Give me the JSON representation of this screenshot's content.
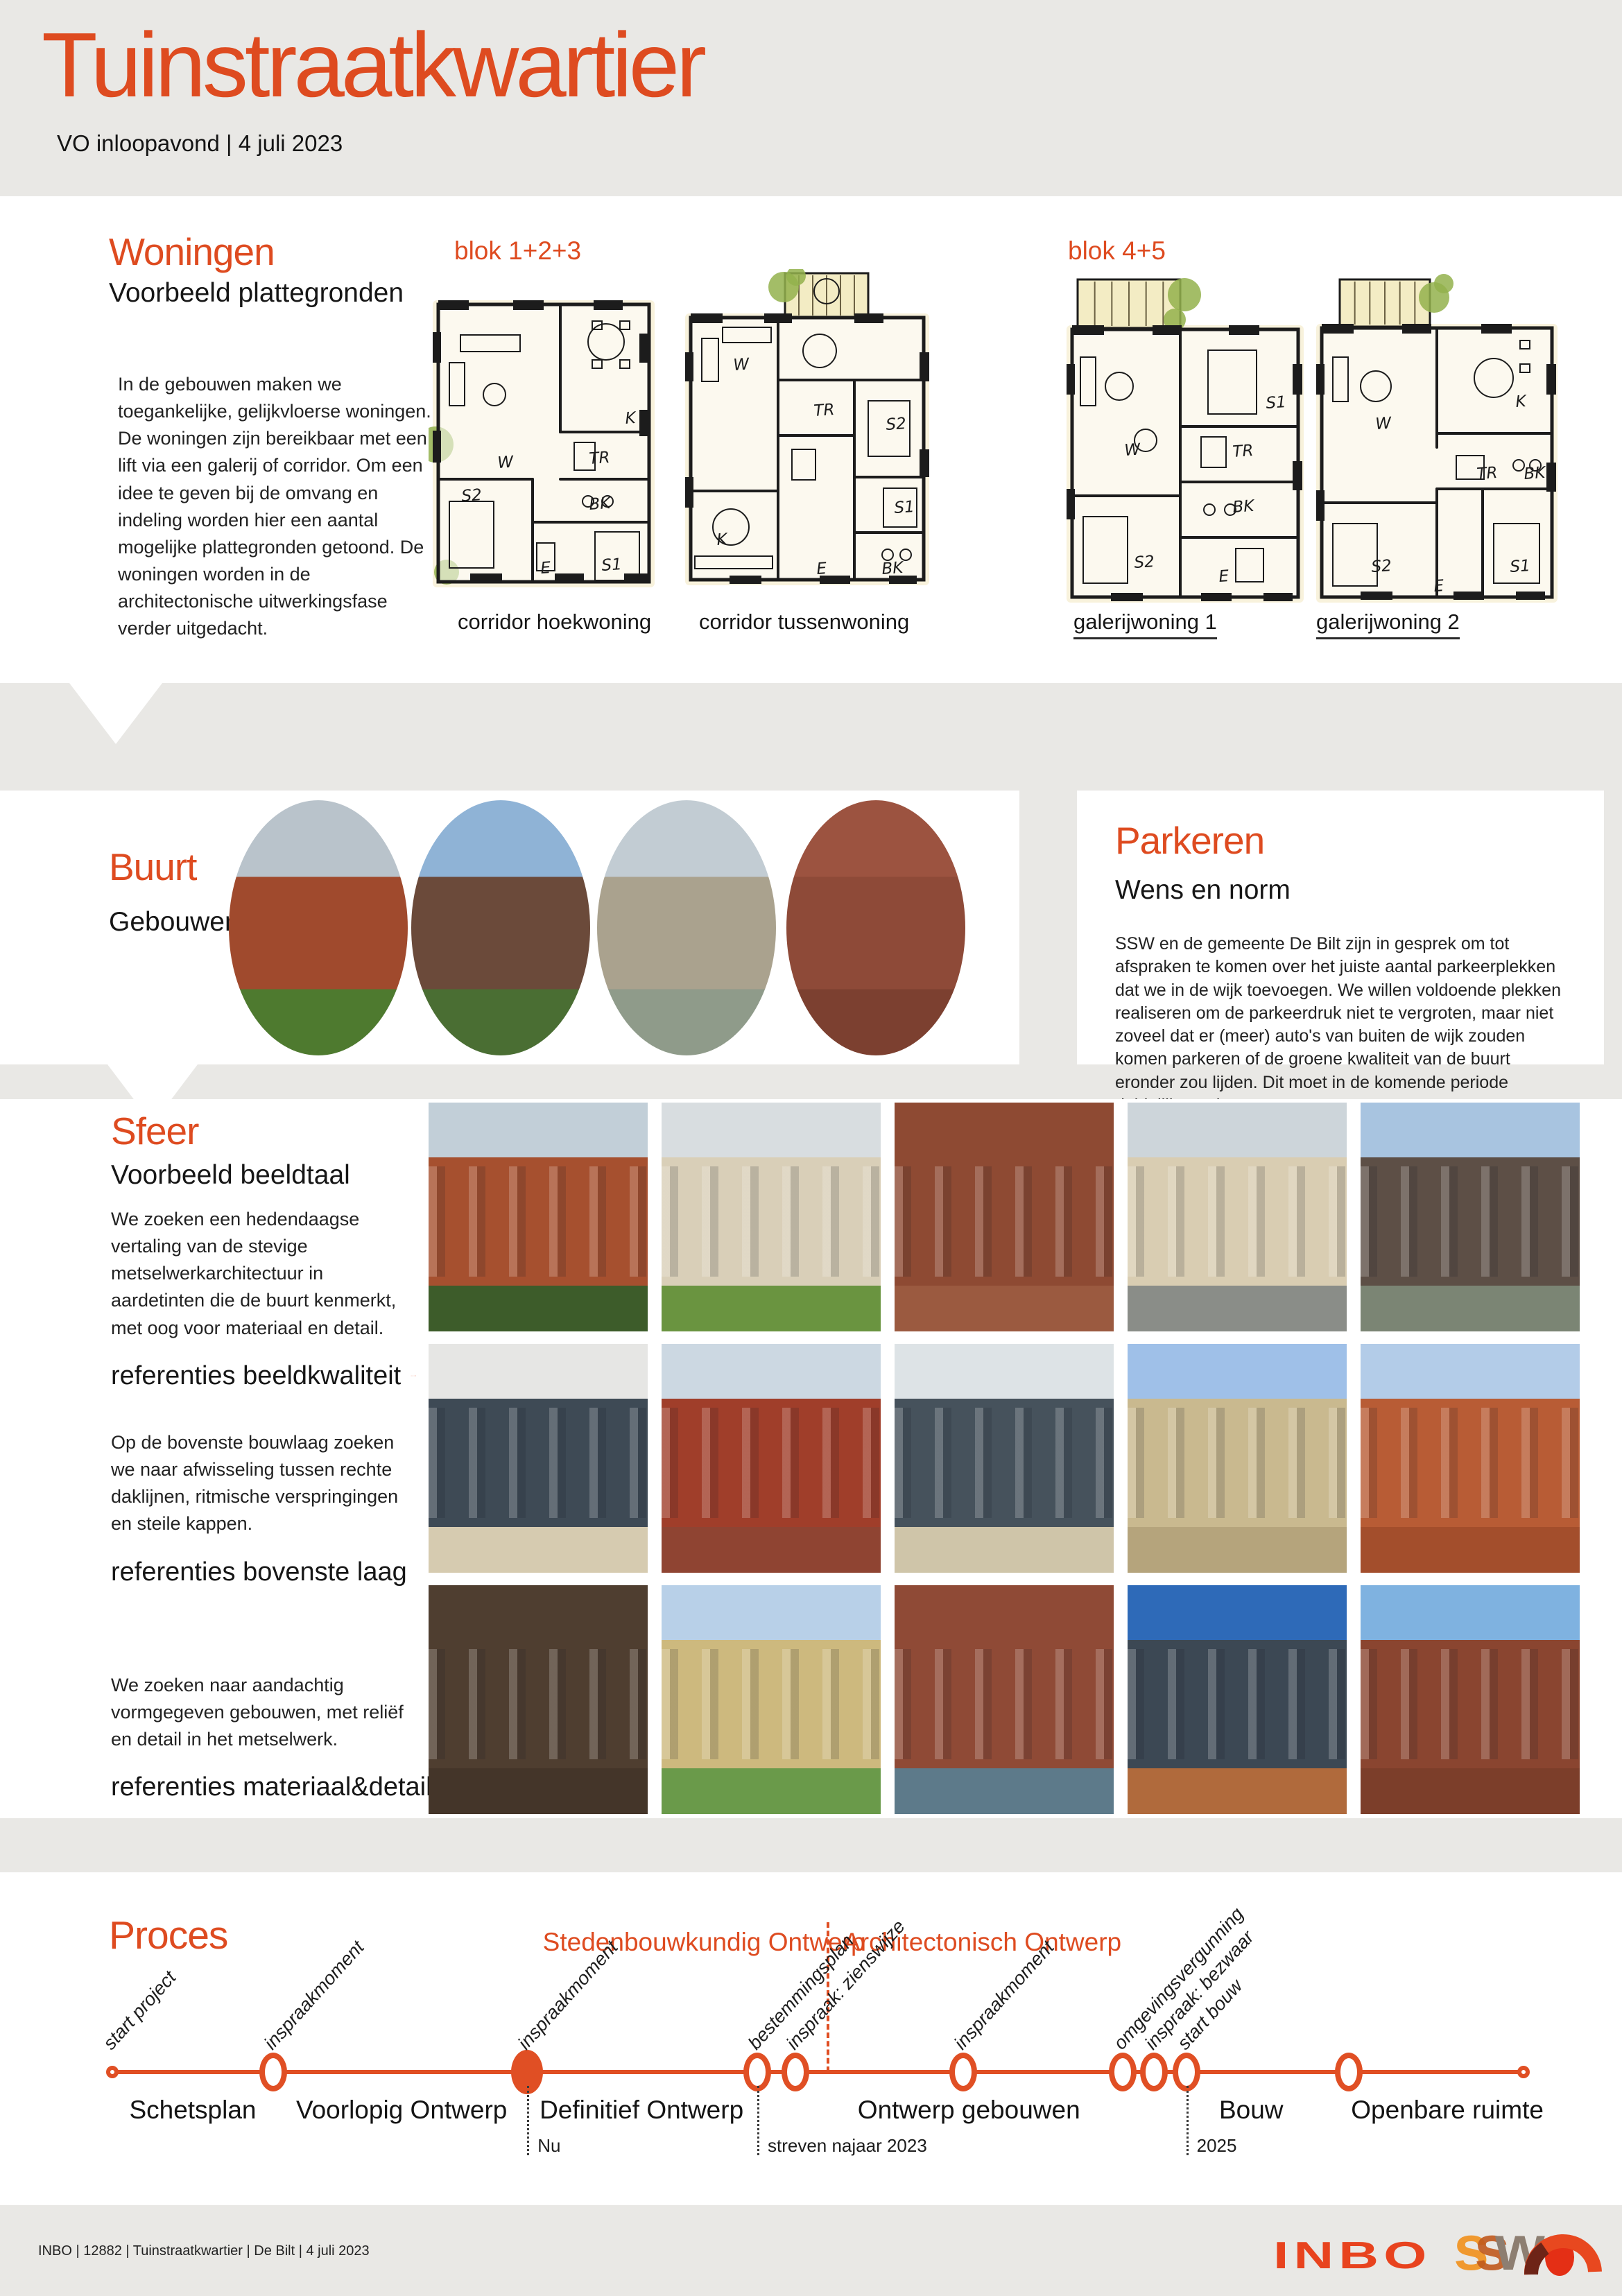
{
  "page": {
    "title": "Tuinstraatkwartier",
    "subtitle": "VO inloopavond | 4 juli 2023",
    "accent": "#de4b20"
  },
  "woningen": {
    "title": "Woningen",
    "subtitle": "Voorbeeld plattegronden",
    "body": "In de gebouwen maken we toegankelijke, gelijkvloerse woningen. De woningen zijn bereikbaar met een lift via een galerij of corridor. Om een idee te geven bij de omvang en indeling worden hier een aantal mogelijke plattegronden getoond. De woningen worden in de architectonische uitwerkingsfase verder uitgedacht.",
    "blok_labels": [
      "blok 1+2+3",
      "blok 4+5"
    ],
    "plans": [
      {
        "label": "corridor hoekwoning",
        "rooms": [
          "W",
          "K",
          "TR",
          "BK",
          "S2",
          "S1",
          "E"
        ]
      },
      {
        "label": "corridor tussenwoning",
        "rooms": [
          "W",
          "K",
          "S2",
          "S1",
          "TR",
          "BK",
          "E"
        ]
      },
      {
        "label": "galerijwoning 1",
        "rooms": [
          "W",
          "S1",
          "TR",
          "BK",
          "S2",
          "E"
        ]
      },
      {
        "label": "galerijwoning 2",
        "rooms": [
          "W",
          "K",
          "TR",
          "BK",
          "S2",
          "S1",
          "E"
        ]
      }
    ]
  },
  "buurt": {
    "title": "Buurt",
    "subtitle": "Gebouwen",
    "photos": [
      {
        "name": "brick-row-houses-greenery",
        "sky": "#b9c3cb",
        "a": "#a04a2d",
        "b": "#4e7a2f"
      },
      {
        "name": "brown-school-building",
        "sky": "#8fb3d6",
        "a": "#6b4a3a",
        "b": "#4a6e33"
      },
      {
        "name": "house-solar-panels",
        "sky": "#c2ccd3",
        "a": "#aaa28e",
        "b": "#8f9b8a"
      },
      {
        "name": "brick-chapel-facade",
        "sky": "#9c5340",
        "a": "#8e4a38",
        "b": "#7c4030"
      }
    ]
  },
  "parkeren": {
    "title": "Parkeren",
    "subtitle": "Wens en norm",
    "body": "SSW en de gemeente De Bilt zijn in gesprek om tot afspraken te komen over het juiste aantal parkeerplekken dat we in de wijk toevoegen. We willen voldoende plekken realiseren om de parkeerdruk niet te vergroten, maar niet zoveel dat er (meer) auto's van buiten de wijk zouden komen parkeren of de groene kwaliteit van de buurt eronder zou lijden. Dit moet in de komende periode duidelijk worden."
  },
  "sfeer": {
    "title": "Sfeer",
    "subtitle": "Voorbeeld beeldtaal",
    "rows": [
      {
        "body": "We zoeken een hedendaagse vertaling van de stevige metselwerkarchitectuur in aardetinten die de buurt kenmerkt, met oog voor materiaal en detail.",
        "caption": "referenties beeldkwaliteit",
        "photos": [
          {
            "name": "red-brick-tree",
            "sky": "#c2cfd8",
            "a": "#a6502f",
            "b": "#3d5c2a"
          },
          {
            "name": "cream-building-grass",
            "sky": "#d8dde0",
            "a": "#d9cfb8",
            "b": "#6a9440"
          },
          {
            "name": "brick-vertical-windows",
            "sky": "#8e4a33",
            "a": "#8e4a33",
            "b": "#9b5a40"
          },
          {
            "name": "beige-dark-roof",
            "sky": "#cdd5da",
            "a": "#d9cdb2",
            "b": "#8a8d88"
          },
          {
            "name": "dark-bay-windows",
            "sky": "#a8c4e0",
            "a": "#5d4f46",
            "b": "#7b8574"
          }
        ]
      },
      {
        "body": "Op de bovenste bouwlaag zoeken we naar afwisseling tussen rechte daklijnen, ritmische verspringingen en steile kappen.",
        "caption": "referenties bovenste laag",
        "photos": [
          {
            "name": "cream-setback-top",
            "sky": "#e6e6e4",
            "a": "#3e4a55",
            "b": "#d6cbb0"
          },
          {
            "name": "terracotta-red-roof",
            "sky": "#ccd8e2",
            "a": "#a03e2a",
            "b": "#8f4432"
          },
          {
            "name": "beige-zinc-mansard",
            "sky": "#dde3e6",
            "a": "#46525c",
            "b": "#cfc5a9"
          },
          {
            "name": "sand-brick-stepped",
            "sky": "#9fc0e8",
            "a": "#c9b98f",
            "b": "#b5a47c"
          },
          {
            "name": "orange-brick-terrace",
            "sky": "#b3cce8",
            "a": "#b85c35",
            "b": "#a34e2c"
          }
        ]
      },
      {
        "body": "We zoeken naar aandachtig vormgegeven gebouwen, met reliëf en detail in het metselwerk.",
        "caption": "referenties materiaal&detail",
        "photos": [
          {
            "name": "dark-relief-brick",
            "sky": "#4f3e30",
            "a": "#4f3e30",
            "b": "#443529"
          },
          {
            "name": "yellow-brick-trees",
            "sky": "#b8d0e8",
            "a": "#cdb97e",
            "b": "#6a9a4a"
          },
          {
            "name": "red-brick-grid",
            "sky": "#8f4a36",
            "a": "#8f4a36",
            "b": "#5d7a8a"
          },
          {
            "name": "dark-roof-blue-sky",
            "sky": "#2e6ab8",
            "a": "#3c4854",
            "b": "#b06a3c"
          },
          {
            "name": "vertical-brick-ribs",
            "sky": "#7fb2e0",
            "a": "#8a4530",
            "b": "#7c3e2a"
          }
        ]
      }
    ]
  },
  "proces": {
    "title": "Proces",
    "phase_headers": [
      "Stedenbouwkundig Ontwerp",
      "Architectonisch Ontwerp"
    ],
    "divider_pos": 50.6,
    "milestones": [
      {
        "label": "start project",
        "pos": 0,
        "type": "small"
      },
      {
        "label": "inspraakmoment",
        "pos": 11.4,
        "type": "open"
      },
      {
        "label": "inspraakmoment",
        "pos": 29.4,
        "type": "filled"
      },
      {
        "label": "bestemmingsplan",
        "pos": 45.7,
        "type": "open"
      },
      {
        "label": "inspraak: zienswijze",
        "pos": 48.4,
        "type": "open"
      },
      {
        "label": "inspraakmoment",
        "pos": 60.3,
        "type": "open"
      },
      {
        "label": "omgevingsvergunning",
        "pos": 71.6,
        "type": "open"
      },
      {
        "label": "inspraak: bezwaar",
        "pos": 73.8,
        "type": "open"
      },
      {
        "label": "start bouw",
        "pos": 76.1,
        "type": "open"
      },
      {
        "label": "",
        "pos": 87.6,
        "type": "open"
      },
      {
        "label": "",
        "pos": 100,
        "type": "small"
      }
    ],
    "phases": [
      {
        "label": "Schetsplan",
        "pos": 5.7
      },
      {
        "label": "Voorlopig Ontwerp",
        "pos": 20.5
      },
      {
        "label": "Definitief Ontwerp",
        "pos": 37.5
      },
      {
        "label": "Ontwerp gebouwen",
        "pos": 60.7
      },
      {
        "label": "Bouw",
        "pos": 80.7
      },
      {
        "label": "Openbare ruimte",
        "pos": 94.6
      }
    ],
    "time_markers": [
      {
        "label": "Nu",
        "pos": 29.4
      },
      {
        "label": "streven najaar 2023",
        "pos": 45.7
      },
      {
        "label": "2025",
        "pos": 76.1
      }
    ]
  },
  "footer": {
    "credits": "INBO | 12882 | Tuinstraatkwartier | De Bilt | 4 juli 2023",
    "logo_inbo": "INBO",
    "logo_ssw": "ssw"
  }
}
